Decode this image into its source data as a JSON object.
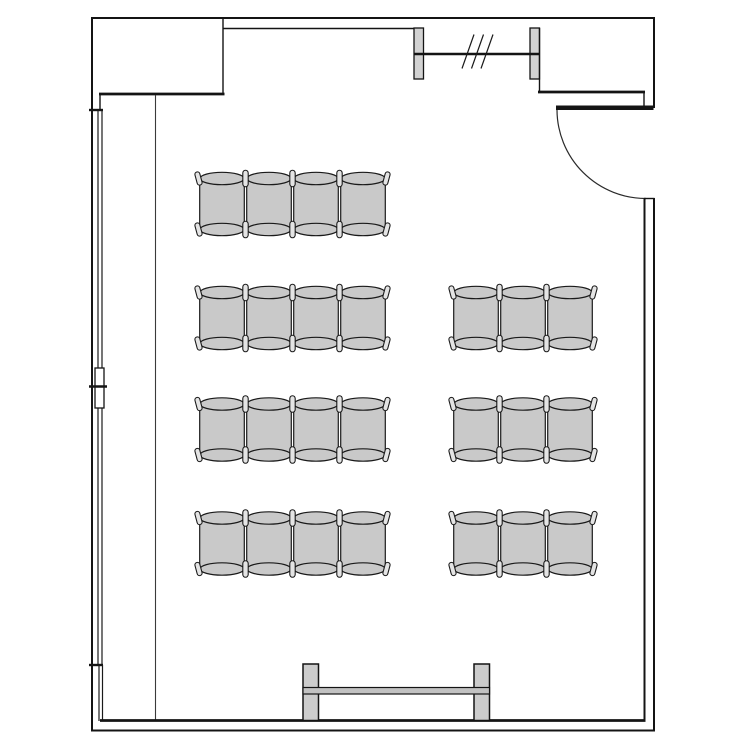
{
  "canvas": {
    "width": 750,
    "height": 750
  },
  "colors": {
    "background": "#ffffff",
    "wall_line": "#141414",
    "seat_fill": "#c9c9c9",
    "pill_fill": "#e4e4e4",
    "fixture_fill": "#d2d2d2",
    "rail_fill": "#c2c2c2"
  },
  "chair_style": {
    "width": 47,
    "seat_span": 51,
    "ellipse_rx": 22,
    "ellipse_ry": 6.2,
    "side_inset": 1.2,
    "pill_w": 5.4,
    "pill_h": 16.5,
    "end_pill_w": 5,
    "end_pill_h": 13.5,
    "end_tilt_deg": 15
  },
  "chair_rows": [
    {
      "id": "left-row-1",
      "x": 198.5,
      "y": 178.5,
      "count": 4
    },
    {
      "id": "left-row-2",
      "x": 198.5,
      "y": 292.5,
      "count": 4
    },
    {
      "id": "left-row-3",
      "x": 198.5,
      "y": 404.0,
      "count": 4
    },
    {
      "id": "left-row-4",
      "x": 198.5,
      "y": 518.0,
      "count": 4
    },
    {
      "id": "right-row-1",
      "x": 452.5,
      "y": 292.5,
      "count": 3
    },
    {
      "id": "right-row-2",
      "x": 452.5,
      "y": 404.0,
      "count": 3
    },
    {
      "id": "right-row-3",
      "x": 452.5,
      "y": 518.0,
      "count": 3
    }
  ],
  "total_chairs": 25,
  "presentation_board": {
    "x": 303,
    "top": 664,
    "width": 186.5,
    "post_width": 15.5,
    "post_height": 56.5,
    "rail_y": 687.5,
    "rail_height": 6.5
  },
  "door": {
    "wall": "right-upper",
    "opening_top_y": 110,
    "opening_bottom_y": 198,
    "leaf_x1": 556,
    "leaf_x2": 653.5,
    "swing": "quarter-circle-inward",
    "arc_radius": 89
  },
  "windows": {
    "top_wall": {
      "jamb1_x": 414,
      "jamb2_x": 530,
      "jamb_width": 9.5,
      "jamb_top": 28,
      "jamb_height": 51,
      "glazing_y": 54,
      "slash_count": 3
    },
    "left_wall": {
      "y_top": 110,
      "y_bottom": 665,
      "glazing_x1": 98,
      "glazing_x2": 102,
      "mullion_y1": 368,
      "mullion_y2": 408,
      "mullion_tick_y": 386.5
    }
  }
}
